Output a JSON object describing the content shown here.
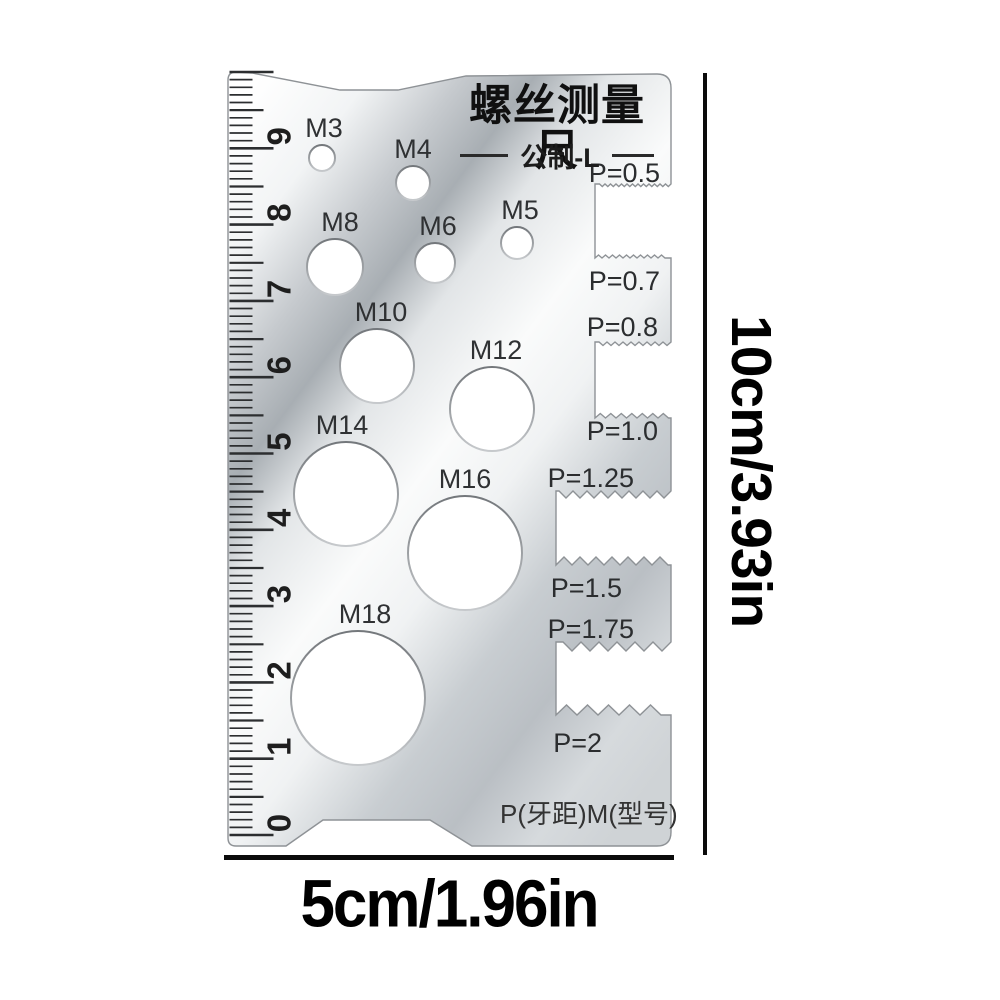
{
  "page": {
    "background_color": "#ffffff"
  },
  "card": {
    "title": "螺丝测量尺",
    "subtitle": "公制-L",
    "footer_label": "P(牙距)M(型号)",
    "metal_light_color": "#fbfcfd",
    "metal_dark_color": "#a8aeb3",
    "holes": [
      {
        "label": "M3",
        "cx": 322,
        "cy": 158,
        "r": 13,
        "label_dx": 2
      },
      {
        "label": "M4",
        "cx": 413,
        "cy": 183,
        "r": 17,
        "label_dx": 0
      },
      {
        "label": "M5",
        "cx": 517,
        "cy": 243,
        "r": 16,
        "label_dx": 3
      },
      {
        "label": "M6",
        "cx": 435,
        "cy": 263,
        "r": 20,
        "label_dx": 3
      },
      {
        "label": "M8",
        "cx": 335,
        "cy": 267,
        "r": 28,
        "label_dx": 5
      },
      {
        "label": "M10",
        "cx": 377,
        "cy": 366,
        "r": 37,
        "label_dx": 4
      },
      {
        "label": "M12",
        "cx": 492,
        "cy": 409,
        "r": 42,
        "label_dx": 4
      },
      {
        "label": "M14",
        "cx": 346,
        "cy": 494,
        "r": 52,
        "label_dx": -4
      },
      {
        "label": "M16",
        "cx": 465,
        "cy": 553,
        "r": 57,
        "label_dx": 0
      },
      {
        "label": "M18",
        "cx": 358,
        "cy": 698,
        "r": 67,
        "label_dx": 7
      }
    ],
    "pitch_labels": [
      {
        "label": "P=0.5",
        "x": 660,
        "y": 182
      },
      {
        "label": "P=0.7",
        "x": 660,
        "y": 290
      },
      {
        "label": "P=0.8",
        "x": 658,
        "y": 336
      },
      {
        "label": "P=1.0",
        "x": 658,
        "y": 440
      },
      {
        "label": "P=1.25",
        "x": 634,
        "y": 487
      },
      {
        "label": "P=1.5",
        "x": 622,
        "y": 597
      },
      {
        "label": "P=1.75",
        "x": 634,
        "y": 638
      },
      {
        "label": "P=2",
        "x": 602,
        "y": 752
      }
    ],
    "ruler": {
      "numbers": [
        "0",
        "1",
        "2",
        "3",
        "4",
        "5",
        "6",
        "7",
        "8",
        "9"
      ],
      "origin_y": 835,
      "unit_px": 76.3
    }
  },
  "annotations": {
    "height_label": "10cm/3.93in",
    "width_label": "5cm/1.96in",
    "line_color": "#0b0b0b"
  }
}
